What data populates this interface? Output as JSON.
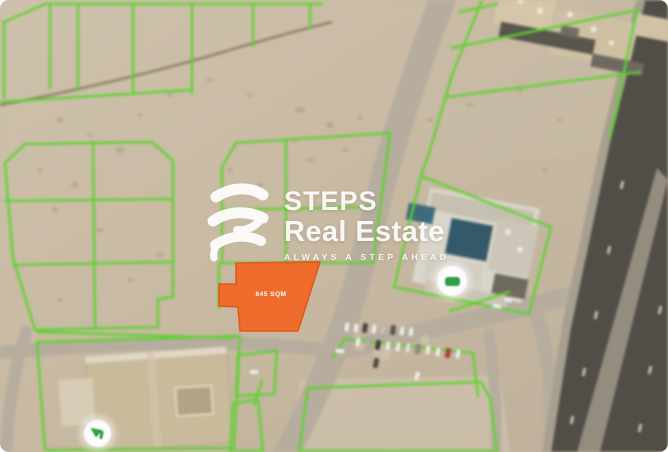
{
  "listing_image": {
    "plot_label": "645 SQM"
  },
  "watermark": {
    "brand": "STEPS",
    "brand_line2": "Real Estate",
    "tagline": "ALWAYS A STEP AHEAD"
  },
  "icons": {
    "logo": "steps-swoosh-icon",
    "marker_compound": "round-location-marker",
    "marker_mosque": "round-tree-marker"
  },
  "colors": {
    "sand": "#c8b9a3",
    "plot-line-green": "#5ed22f",
    "accent-orange": "#f26a2a",
    "orange-border": "#dd5817",
    "road-light": "#b6ad9e",
    "asphalt-dark": "#514e48",
    "median-gray": "#948d7f",
    "pool-blue": "#33596a",
    "marker-green": "#2f9e44",
    "watermark-white": "#ffffff"
  }
}
